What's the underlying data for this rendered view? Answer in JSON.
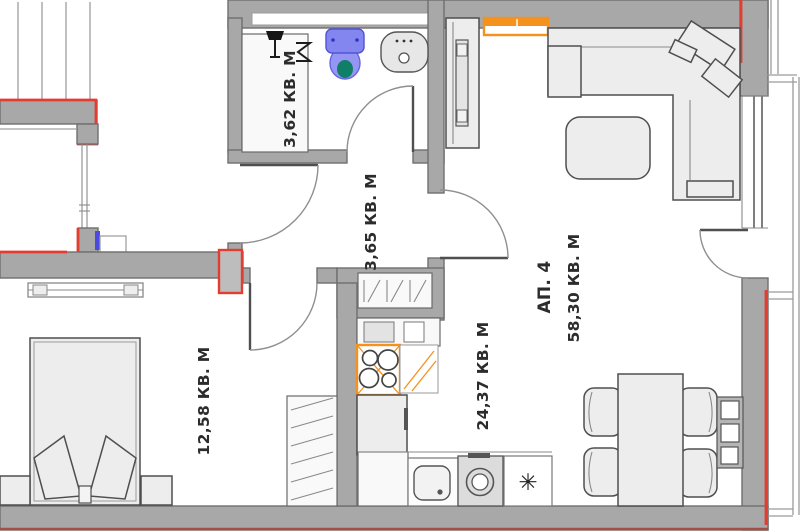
{
  "plan": {
    "apartment_label": "АП. 4",
    "apartment_total_area": "58,30 КВ. М",
    "rooms": {
      "bathroom_area": "3,62 КВ. М",
      "hallway_area": "3,65 КВ. М",
      "kitchen_living_area": "24,37 КВ. М",
      "bedroom_area": "12,58 КВ. М"
    },
    "symbols": {
      "dishwasher_asterisk": "✳"
    },
    "colors": {
      "wall": "#a8a8a8",
      "wall_outline": "#6f6f6f",
      "accent_red": "#e23d30",
      "accent_orange": "#f5921e",
      "fixture_blue": "#8486ef",
      "fixture_blue_dark": "#5153d6",
      "toilet_seat_teal": "#0f7f68",
      "furniture_fill": "#ededed",
      "bottom_boundary_line": "#a34f45"
    }
  }
}
